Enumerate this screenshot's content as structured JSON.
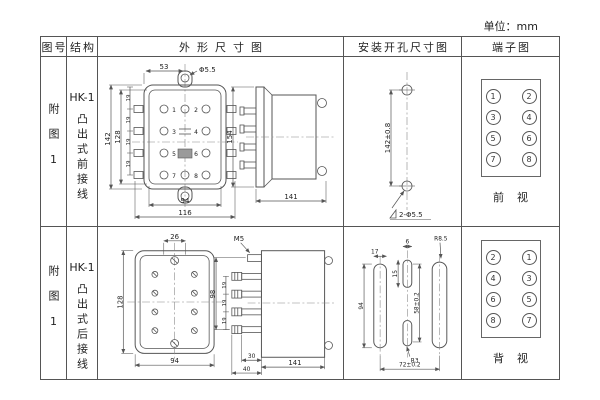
{
  "unit_note": "单位：mm",
  "header": {
    "figure": "图号",
    "structure": "结构",
    "outline": "外形尺寸图",
    "mounting": "安装开孔尺寸图",
    "terminal": "端子图"
  },
  "rows": [
    {
      "figure_no": "附图1",
      "model": "HK-1",
      "structure": "凸出式前接线",
      "outline": {
        "top_span": "53",
        "hole_dia": "Φ5.5",
        "height_outer": "142",
        "height_inner": "128",
        "pitch": [
          "19",
          "19",
          "19",
          "19"
        ],
        "width_inner": "94",
        "width_outer": "116",
        "terminals": [
          "1",
          "2",
          "3",
          "4",
          "5",
          "6",
          "7",
          "8"
        ],
        "side_height": "154",
        "depth": "141"
      },
      "mounting": {
        "hole_pitch": "142±0.8",
        "hole_note": "2-Φ5.5"
      },
      "terminal_view": {
        "cells": [
          [
            "1",
            "2"
          ],
          [
            "3",
            "4"
          ],
          [
            "5",
            "6"
          ],
          [
            "7",
            "8"
          ]
        ],
        "caption": "前视"
      }
    },
    {
      "figure_no": "附图1",
      "model": "HK-1",
      "structure": "凸出式后接线",
      "outline": {
        "top_span": "26",
        "height": "128",
        "width": "94",
        "screw": "M5",
        "stud_span": "98",
        "pitch": [
          "19",
          "19",
          "19"
        ],
        "depth_a": "30",
        "depth_b": "40",
        "depth": "141"
      },
      "mounting": {
        "slot_width": "17",
        "slot_height": "94",
        "mid_slot_width": "6",
        "mid_slot_len": "15",
        "mid_span": "58±0.2",
        "corner_radius": "R8.5",
        "slot_radius": "R3",
        "span": "72±0.2"
      },
      "terminal_view": {
        "cells": [
          [
            "2",
            "1"
          ],
          [
            "4",
            "3"
          ],
          [
            "6",
            "5"
          ],
          [
            "8",
            "7"
          ]
        ],
        "caption": "背视"
      }
    }
  ]
}
